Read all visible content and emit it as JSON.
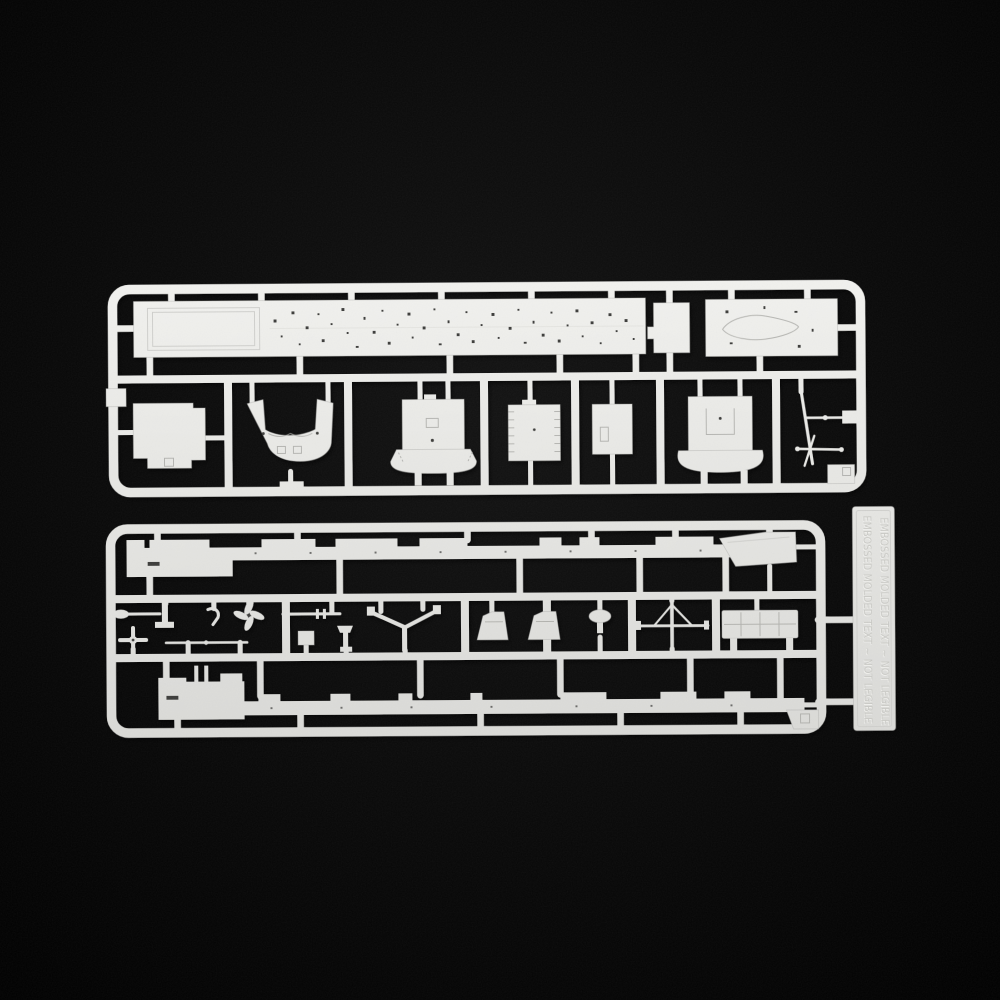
{
  "scene": {
    "type": "photograph",
    "description": "Top-down photograph of two light-grey injection-moulded plastic model-kit sprues (runners) with warship parts, lying on a black background",
    "objects": [
      "upper parts sprue",
      "lower parts sprue with embossed identification tag"
    ]
  },
  "colors": {
    "background": "#050505",
    "plastic": "#e7e7e4",
    "plastic_light": "#f3f3f0",
    "plastic_dark": "#cfcfcc",
    "edge_shadow": "#a6a6a3",
    "engraving": "#3c3c3a",
    "emboss_text": "#c9c9c5"
  },
  "top_sprue": {
    "parts": [
      "long flight/main deck with elevator outline and scattered tie-down holes",
      "small stepped side plate",
      "bow deck plate with teardrop engraving",
      "angled side plate",
      "stern section with twin raised bulwarks and two square openings",
      "superstructure front with flared serrated apron",
      "platform with hatched railing edges",
      "small deckhouse box",
      "funnel casing with flared skirt",
      "thin aerial / mast spar cluster",
      "corner gusset plate",
      "small tab plate on left frame"
    ]
  },
  "bottom_sprue": {
    "parts": [
      "port waterline hull half with raised deckhouse blocks",
      "bow side plate",
      "paddle / oar",
      "bollard pin",
      "davit hook",
      "four-blade propeller",
      "small propeller",
      "yardarm rod",
      "tapered topmast / gun barrel",
      "small box fitting",
      "pedestal vent",
      "V-shaped mast spreader",
      "bridge windshield (two)",
      "mushroom vent",
      "mainmast with long yard and braces",
      "life-raft rack panel",
      "starboard waterline hull half with twin pins",
      "corner wedge plate",
      "embossed identification tag"
    ]
  },
  "tag": {
    "embossed_line_1": "EMBOSSED MOLDED TEXT ~ NOT LEGIBLE",
    "embossed_line_2": "EMBOSSED MOLDED TEXT ~ NOT LEGIBLE",
    "legibility": "two vertical lines of molded lettering, too faint to read"
  }
}
